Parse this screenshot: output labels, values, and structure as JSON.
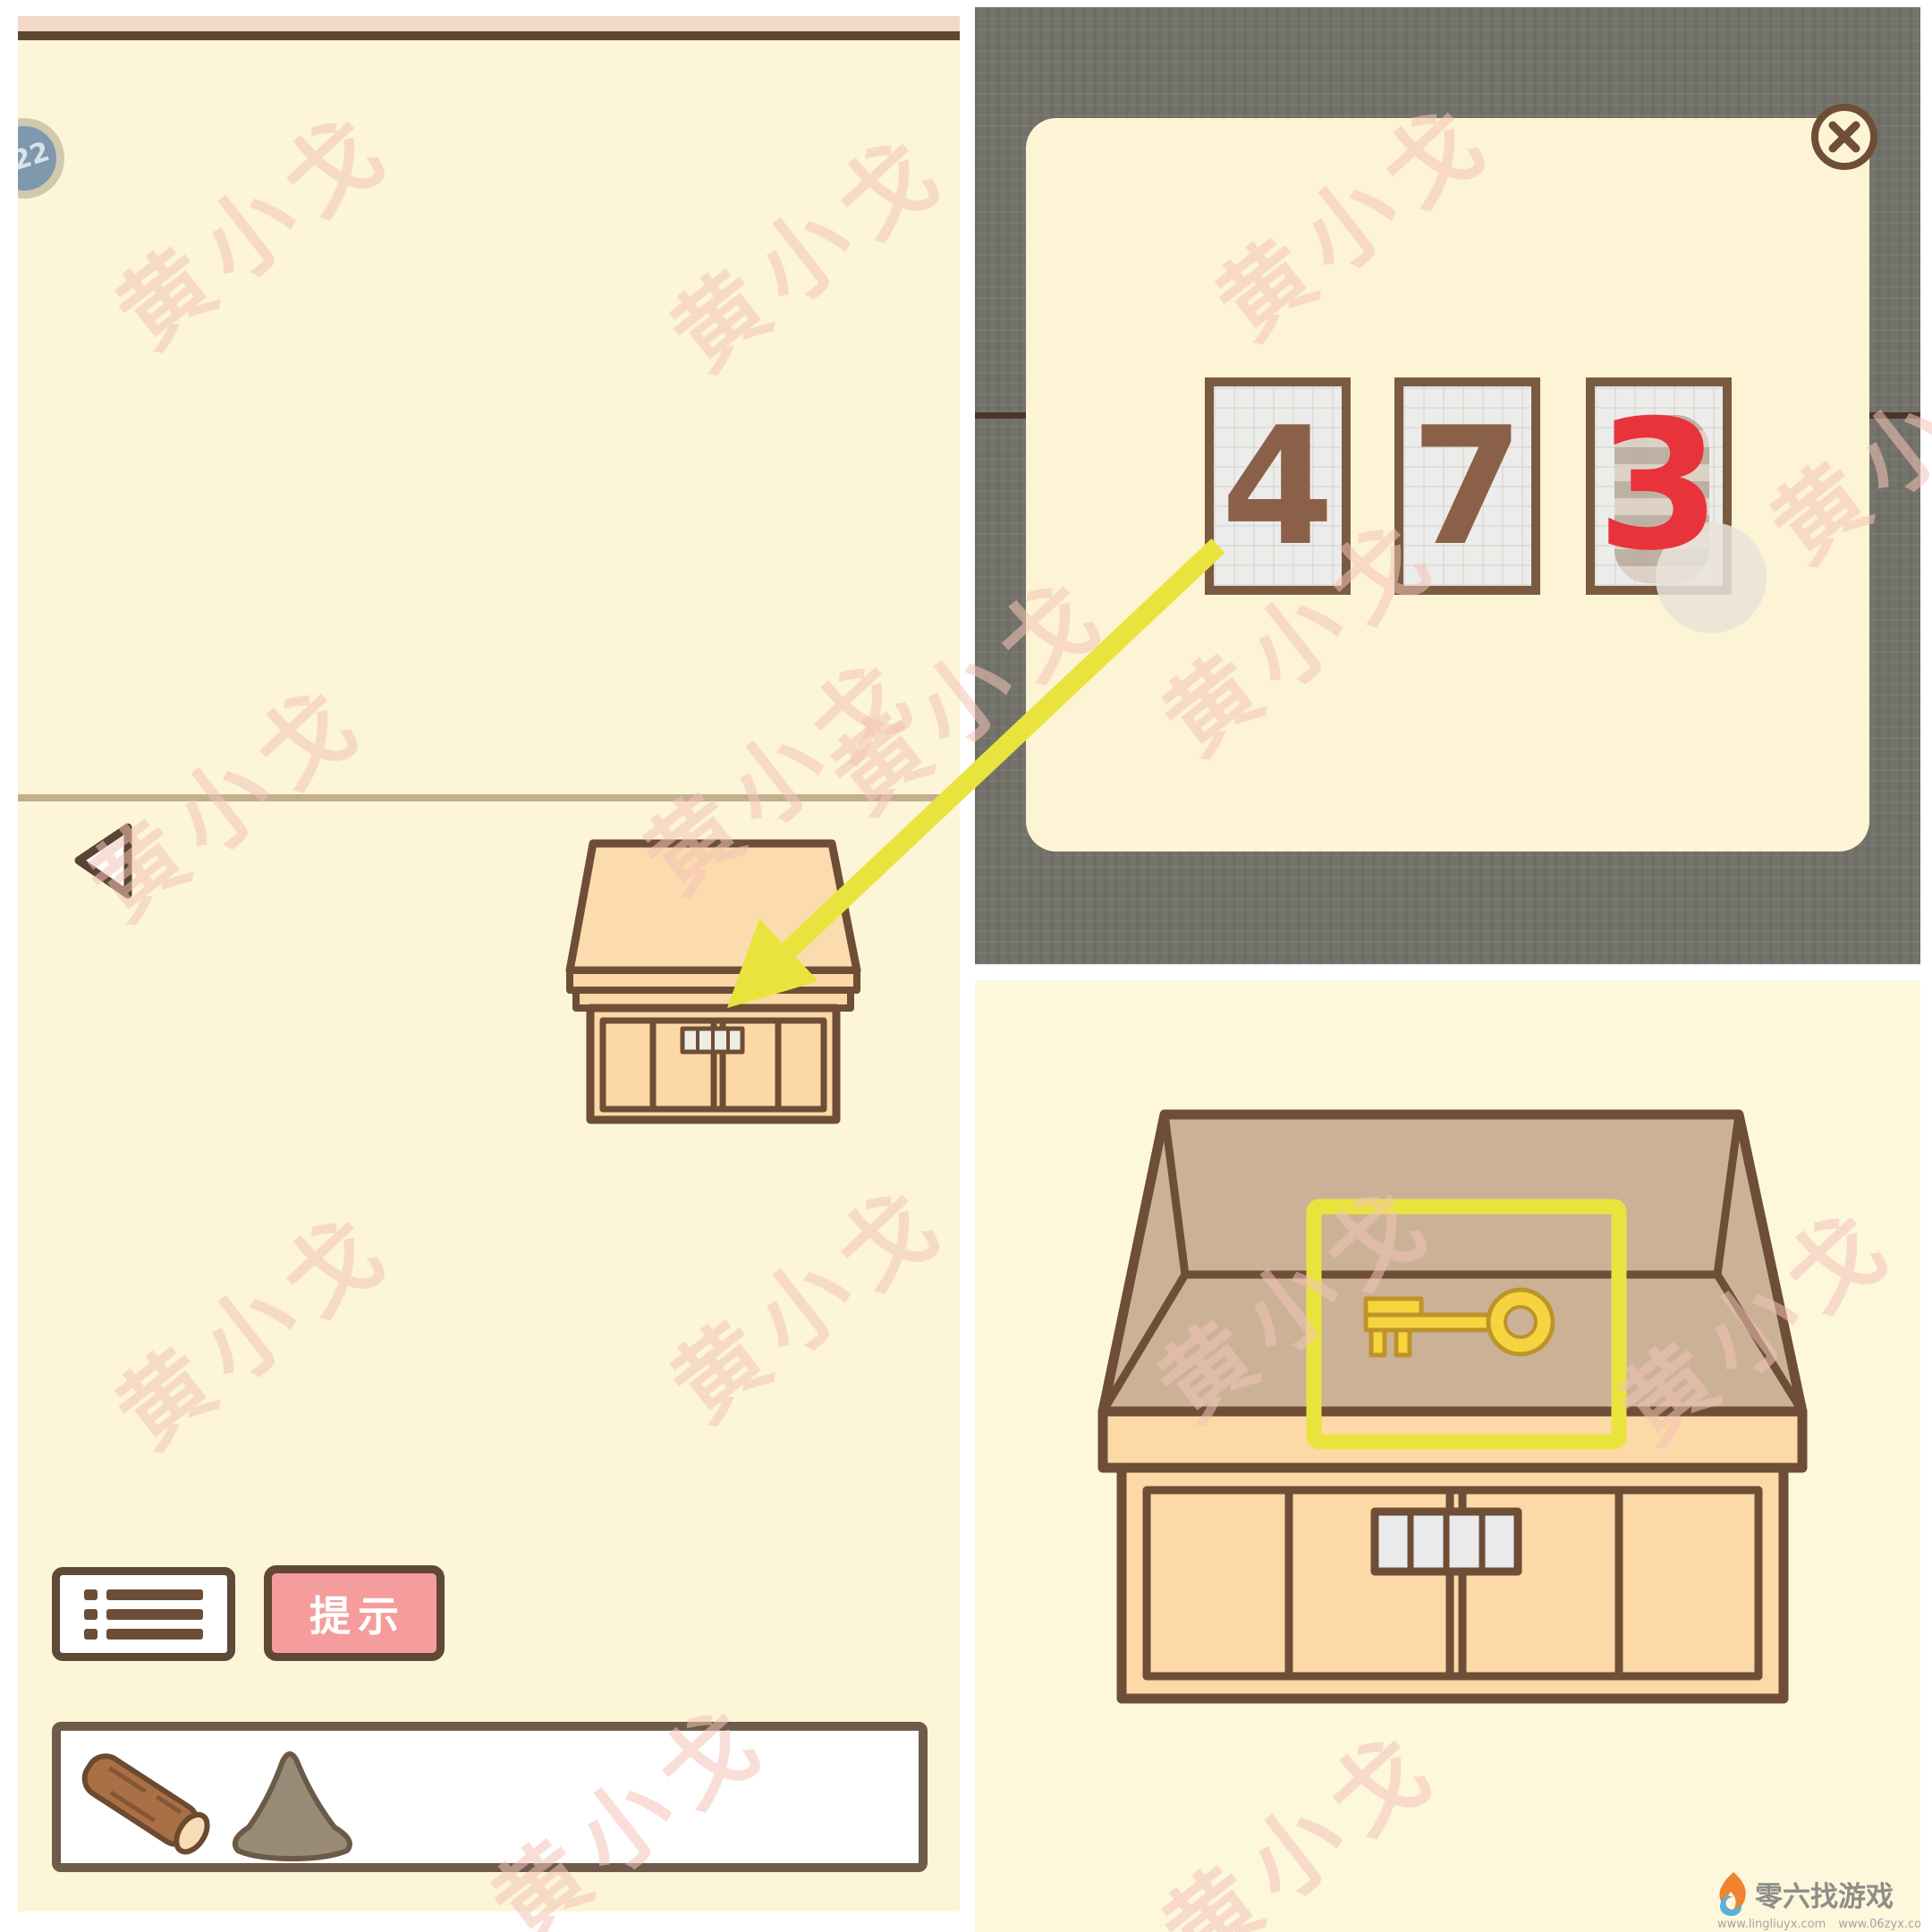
{
  "watermark": {
    "text": "黄小戈"
  },
  "left_panel": {
    "level_badge": "22",
    "hint_button_label": "提示",
    "inventory_items": [
      {
        "name": "wood-log"
      },
      {
        "name": "dust-pile"
      }
    ]
  },
  "code_popup": {
    "digit_1": "4",
    "digit_2": "7",
    "digit_3_annotation": "3",
    "close_icon": "close-icon"
  },
  "bottom_right": {
    "highlighted_item": "gold-key",
    "lock_display_cells": 4
  },
  "footer_logo": {
    "site_name": "零六找游戏",
    "url_1": "www.lingliuyx.com",
    "url_2": "www.06zyx.com"
  },
  "colors": {
    "annotation_red": "#e8333b",
    "arrow_yellow": "#e9e43d",
    "highlight_yellow": "#e9e43d",
    "hint_pink": "#f59c9c",
    "panel_cream": "#fcf5d8",
    "dark_backdrop": "#73736b"
  }
}
